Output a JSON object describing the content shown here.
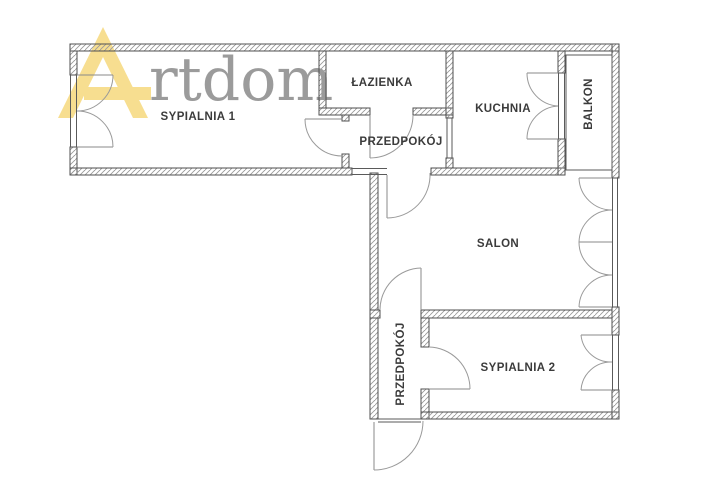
{
  "watermark": {
    "brand_mark_letter": "A",
    "brand_text": "rtdom",
    "mark_color": "#F2C94C",
    "text_color": "#9B9B9B"
  },
  "floorplan": {
    "wall_line_color": "#4F4F4F",
    "rooms": [
      {
        "id": "sypialnia-1",
        "label": "SYPIALNIA 1"
      },
      {
        "id": "lazienka",
        "label": "ŁAZIENKA"
      },
      {
        "id": "przedpokoj-gorny",
        "label": "PRZEDPOKÓJ"
      },
      {
        "id": "kuchnia",
        "label": "KUCHNIA"
      },
      {
        "id": "balkon",
        "label": "BALKON"
      },
      {
        "id": "salon",
        "label": "SALON"
      },
      {
        "id": "przedpokoj-dolny",
        "label": "PRZEDPOKÓJ"
      },
      {
        "id": "sypialnia-2",
        "label": "SYPIALNIA 2"
      }
    ]
  }
}
